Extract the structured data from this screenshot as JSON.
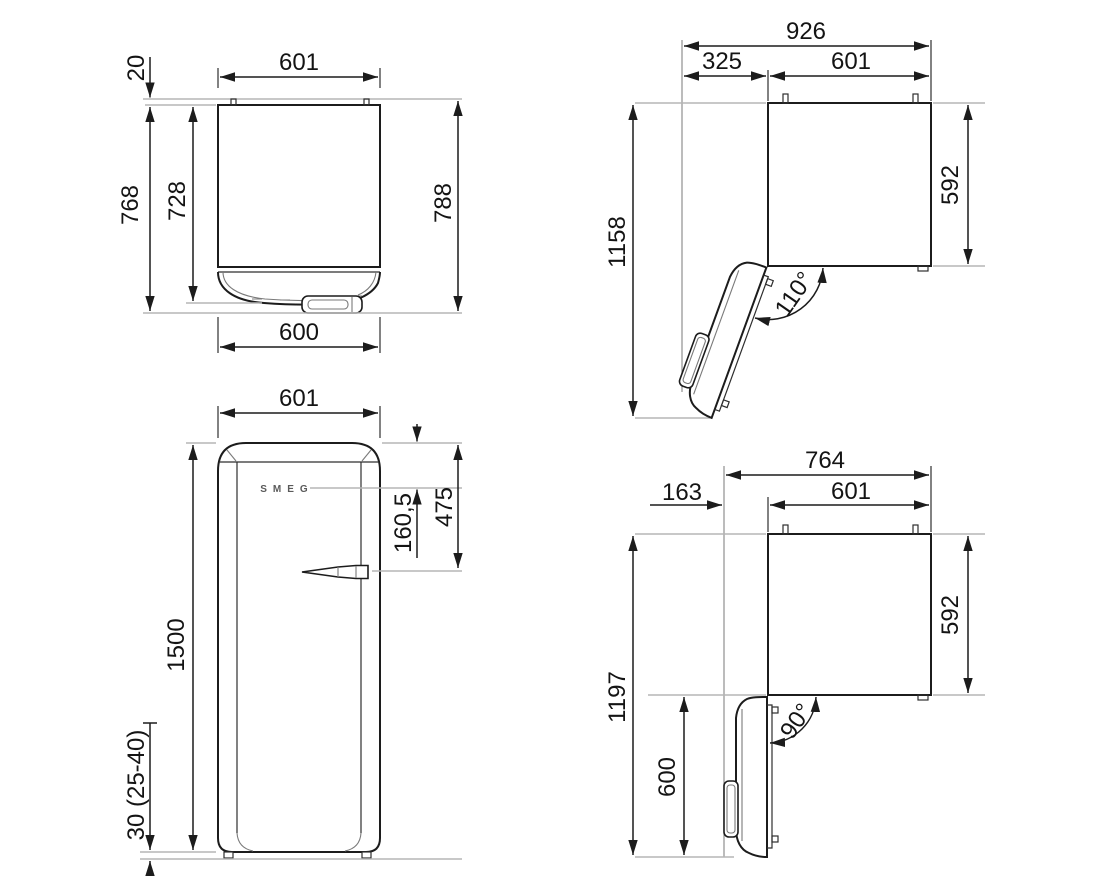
{
  "diagram": {
    "kind": "refrigerator-installation-dimension-drawing",
    "units": "mm",
    "logo": "SMEG",
    "views": {
      "top_closed": {
        "dim_wall_gap": "20",
        "dim_width_body": "601",
        "dim_depth_body": "768",
        "dim_depth_no_handle": "728",
        "dim_depth_total": "788",
        "dim_width_door": "600"
      },
      "top_open_110": {
        "dim_width_total": "926",
        "dim_side_clearance": "325",
        "dim_width_body": "601",
        "dim_depth_total": "1158",
        "dim_depth_body": "592",
        "dim_angle": "110°"
      },
      "front": {
        "dim_width": "601",
        "dim_logo_offset": "160,5",
        "dim_handle_offset": "475",
        "dim_height": "1500",
        "dim_feet": "30 (25-40)"
      },
      "top_open_90": {
        "dim_width_total": "764",
        "dim_side_clearance": "163",
        "dim_width_body": "601",
        "dim_depth_total": "1197",
        "dim_depth_body": "592",
        "dim_door_depth": "600",
        "dim_angle": "90°"
      }
    }
  }
}
